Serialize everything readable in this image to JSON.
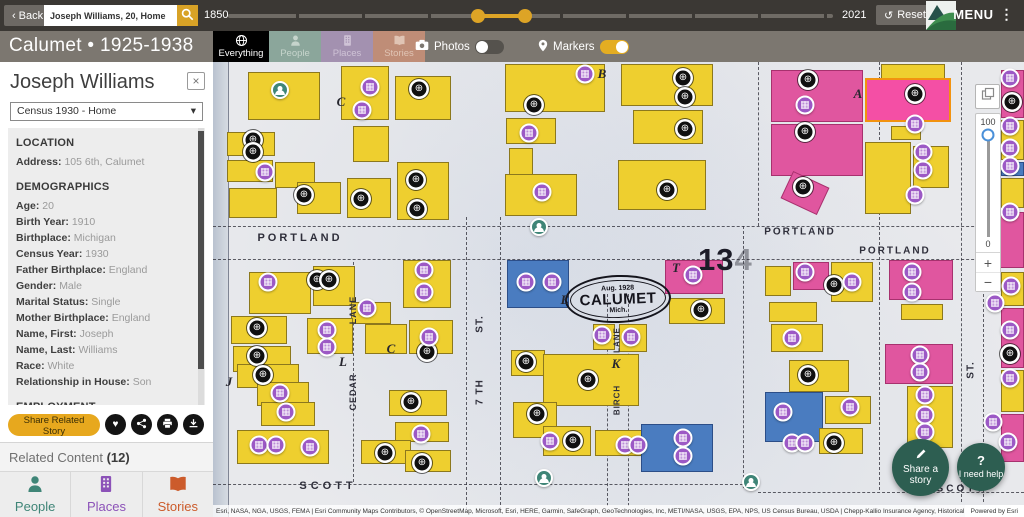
{
  "icons": {
    "back_chevron": "‹",
    "menu_kebab": "⋮",
    "reset": "↺",
    "select_caret": "▾",
    "close": "×",
    "heart": "♥",
    "globe_marker": "⊕",
    "building_marker": "▦",
    "question": "?",
    "plus": "+",
    "minus": "−"
  },
  "colors": {
    "accent_gold": "#dda426",
    "topbar_bg": "#3b3834",
    "subheader_bg": "#7c7770",
    "people_teal": "#3f8577",
    "places_purple": "#8c52b8",
    "stories_orange": "#cc5b2b",
    "marker_record": "#101010",
    "marker_place": "#9c59c5",
    "marker_person": "#3f8577",
    "building_yellow": "#eecf2f",
    "building_pink": "#e0569f",
    "building_blue": "#4a7cc0",
    "fab_teal": "#2d5e51"
  },
  "topbar": {
    "back_label": "Back",
    "search_value": "Joseph Williams, 20, Home",
    "year_start": "1850",
    "year_end": "2021",
    "reset_label": "Reset",
    "menu_label": "MENU"
  },
  "subheader": {
    "title": "Calumet • 1925-1938",
    "tabs": [
      {
        "label": "Everything",
        "active": true
      },
      {
        "label": "People",
        "active": false
      },
      {
        "label": "Places",
        "active": false
      },
      {
        "label": "Stories",
        "active": false
      }
    ],
    "toggles": [
      {
        "label": "Photos",
        "on": false
      },
      {
        "label": "Markers",
        "on": true
      }
    ]
  },
  "sidebar": {
    "person_name": "Joseph Williams",
    "record_select": "Census 1930 - Home",
    "sections": [
      {
        "header": "LOCATION",
        "fields": [
          {
            "label": "Address",
            "value": "105 6th, Calumet"
          }
        ]
      },
      {
        "header": "DEMOGRAPHICS",
        "fields": [
          {
            "label": "Age",
            "value": "20"
          },
          {
            "label": "Birth Year",
            "value": "1910"
          },
          {
            "label": "Birthplace",
            "value": "Michigan"
          },
          {
            "label": "Census Year",
            "value": "1930"
          },
          {
            "label": "Father Birthplace",
            "value": "England"
          },
          {
            "label": "Gender",
            "value": "Male"
          },
          {
            "label": "Marital Status",
            "value": "Single"
          },
          {
            "label": "Mother Birthplace",
            "value": "England"
          },
          {
            "label": "Name, First",
            "value": "Joseph"
          },
          {
            "label": "Name, Last",
            "value": "Williams"
          },
          {
            "label": "Race",
            "value": "White"
          },
          {
            "label": "Relationship in House",
            "value": "Son"
          }
        ]
      },
      {
        "header": "EMPLOYMENT",
        "fields": []
      }
    ],
    "share_button": "Share Related Story",
    "related_label": "Related Content",
    "related_count": "(12)",
    "footer_tabs": [
      {
        "label": "People"
      },
      {
        "label": "Places"
      },
      {
        "label": "Stories"
      }
    ]
  },
  "map": {
    "plate_number": "134",
    "stamp": {
      "top": "Aug. 1928",
      "main": "CALUMET",
      "bottom": "Mich."
    },
    "street_labels": [
      {
        "t": "PORTLAND",
        "x": 87,
        "y": 176,
        "s": 11,
        "ls": 3
      },
      {
        "t": "PORTLAND",
        "x": 587,
        "y": 170,
        "s": 10,
        "ls": 2
      },
      {
        "t": "PORTLAND",
        "x": 682,
        "y": 189,
        "s": 10,
        "ls": 2
      },
      {
        "t": "SCOTT",
        "x": 115,
        "y": 424,
        "s": 11,
        "ls": 4
      },
      {
        "t": "SCOTT",
        "x": 748,
        "y": 427,
        "s": 10,
        "ls": 3
      },
      {
        "t": "LANE",
        "x": 140,
        "y": 248,
        "s": 9,
        "ls": 1,
        "v": true
      },
      {
        "t": "CEDAR",
        "x": 140,
        "y": 330,
        "s": 9,
        "ls": 1,
        "v": true
      },
      {
        "t": "ST.",
        "x": 267,
        "y": 262,
        "s": 10,
        "ls": 1,
        "v": true
      },
      {
        "t": "7 TH",
        "x": 267,
        "y": 330,
        "s": 10,
        "ls": 1,
        "v": true
      },
      {
        "t": "LANE",
        "x": 404,
        "y": 278,
        "s": 8,
        "ls": 1,
        "v": true
      },
      {
        "t": "BIRCH",
        "x": 404,
        "y": 338,
        "s": 8,
        "ls": 1,
        "v": true
      },
      {
        "t": "ST.",
        "x": 758,
        "y": 308,
        "s": 10,
        "ls": 1,
        "v": true
      }
    ],
    "block_letters": [
      {
        "t": "B",
        "x": 389,
        "y": 12
      },
      {
        "t": "C",
        "x": 128,
        "y": 40
      },
      {
        "t": "A",
        "x": 645,
        "y": 32
      },
      {
        "t": "J",
        "x": 16,
        "y": 320
      },
      {
        "t": "L",
        "x": 130,
        "y": 300
      },
      {
        "t": "C",
        "x": 178,
        "y": 287
      },
      {
        "t": "K",
        "x": 403,
        "y": 302
      },
      {
        "t": "T",
        "x": 463,
        "y": 206
      },
      {
        "t": "E",
        "x": 352,
        "y": 238
      }
    ],
    "street_lines": [
      [
        "h",
        0,
        164,
        811
      ],
      [
        "h",
        0,
        197,
        811
      ],
      [
        "h",
        0,
        422,
        530
      ],
      [
        "h",
        545,
        430,
        266
      ],
      [
        "v",
        140,
        200,
        220
      ],
      [
        "v",
        253,
        155,
        293
      ],
      [
        "v",
        287,
        155,
        293
      ],
      [
        "v",
        394,
        232,
        212
      ],
      [
        "v",
        415,
        232,
        212
      ],
      [
        "v",
        530,
        164,
        262
      ],
      [
        "v",
        666,
        0,
        428
      ],
      [
        "v",
        748,
        0,
        440
      ],
      [
        "v",
        545,
        0,
        164
      ],
      [
        "v",
        770,
        197,
        243
      ]
    ],
    "building_colors": {
      "y": "yellow",
      "p": "pink",
      "b": "blue",
      "o": "pink-orange-outline"
    },
    "buildings": [
      [
        "y",
        35,
        10,
        72,
        48
      ],
      [
        "y",
        128,
        4,
        48,
        54
      ],
      [
        "y",
        182,
        14,
        56,
        44
      ],
      [
        "y",
        140,
        64,
        36,
        36
      ],
      [
        "y",
        14,
        70,
        48,
        24
      ],
      [
        "y",
        14,
        98,
        46,
        22
      ],
      [
        "y",
        62,
        100,
        40,
        26
      ],
      [
        "y",
        16,
        126,
        48,
        30
      ],
      [
        "y",
        84,
        120,
        44,
        32
      ],
      [
        "y",
        134,
        116,
        44,
        40
      ],
      [
        "y",
        184,
        100,
        52,
        58
      ],
      [
        "y",
        292,
        2,
        100,
        48
      ],
      [
        "y",
        293,
        56,
        50,
        26
      ],
      [
        "y",
        296,
        86,
        24,
        30
      ],
      [
        "y",
        292,
        112,
        72,
        42
      ],
      [
        "y",
        408,
        2,
        92,
        42
      ],
      [
        "y",
        420,
        48,
        70,
        34
      ],
      [
        "y",
        405,
        98,
        88,
        50
      ],
      [
        "p",
        558,
        8,
        92,
        52
      ],
      [
        "p",
        558,
        62,
        92,
        52
      ],
      [
        "p",
        572,
        116,
        40,
        30,
        25
      ],
      [
        "y",
        668,
        2,
        64,
        26
      ],
      [
        "o",
        652,
        16,
        86,
        44
      ],
      [
        "y",
        678,
        64,
        30,
        14
      ],
      [
        "y",
        652,
        80,
        46,
        72
      ],
      [
        "y",
        700,
        84,
        36,
        42
      ],
      [
        "p",
        788,
        8,
        23,
        48
      ],
      [
        "y",
        788,
        58,
        23,
        40
      ],
      [
        "b",
        788,
        100,
        23,
        14
      ],
      [
        "y",
        788,
        116,
        23,
        30
      ],
      [
        "p",
        770,
        150,
        41,
        56
      ],
      [
        "y",
        788,
        210,
        23,
        34
      ],
      [
        "p",
        788,
        246,
        23,
        60
      ],
      [
        "y",
        788,
        308,
        23,
        42
      ],
      [
        "p",
        788,
        352,
        23,
        48
      ],
      [
        "y",
        36,
        210,
        62,
        42
      ],
      [
        "y",
        100,
        204,
        42,
        40
      ],
      [
        "y",
        190,
        198,
        48,
        48
      ],
      [
        "y",
        138,
        240,
        40,
        22
      ],
      [
        "y",
        94,
        256,
        46,
        36
      ],
      [
        "y",
        18,
        254,
        56,
        28
      ],
      [
        "y",
        20,
        284,
        58,
        26
      ],
      [
        "y",
        24,
        302,
        62,
        24
      ],
      [
        "y",
        44,
        320,
        52,
        24
      ],
      [
        "y",
        48,
        340,
        54,
        24
      ],
      [
        "y",
        24,
        368,
        92,
        34
      ],
      [
        "y",
        152,
        262,
        42,
        30
      ],
      [
        "y",
        196,
        258,
        44,
        34
      ],
      [
        "y",
        176,
        328,
        58,
        26
      ],
      [
        "y",
        182,
        360,
        54,
        20
      ],
      [
        "y",
        148,
        378,
        50,
        24
      ],
      [
        "y",
        192,
        388,
        46,
        22
      ],
      [
        "b",
        294,
        198,
        62,
        48
      ],
      [
        "p",
        452,
        198,
        58,
        34
      ],
      [
        "y",
        456,
        236,
        56,
        26
      ],
      [
        "y",
        380,
        262,
        22,
        26
      ],
      [
        "y",
        406,
        262,
        28,
        28
      ],
      [
        "y",
        298,
        288,
        34,
        26
      ],
      [
        "y",
        330,
        292,
        96,
        52
      ],
      [
        "y",
        300,
        340,
        44,
        36
      ],
      [
        "y",
        330,
        364,
        48,
        30
      ],
      [
        "y",
        382,
        368,
        52,
        26
      ],
      [
        "b",
        428,
        362,
        72,
        48
      ],
      [
        "y",
        552,
        204,
        26,
        30
      ],
      [
        "p",
        580,
        200,
        36,
        28
      ],
      [
        "y",
        618,
        200,
        42,
        40
      ],
      [
        "y",
        556,
        240,
        48,
        20
      ],
      [
        "y",
        558,
        262,
        52,
        28
      ],
      [
        "y",
        576,
        298,
        60,
        32
      ],
      [
        "b",
        552,
        330,
        58,
        50
      ],
      [
        "y",
        612,
        334,
        46,
        28
      ],
      [
        "y",
        606,
        366,
        44,
        26
      ],
      [
        "p",
        676,
        198,
        64,
        40
      ],
      [
        "y",
        688,
        242,
        42,
        16
      ],
      [
        "p",
        672,
        282,
        68,
        40
      ],
      [
        "y",
        694,
        324,
        46,
        62
      ]
    ],
    "marker_types": {
      "r": "record",
      "p": "place",
      "s": "person"
    },
    "markers": [
      [
        "s",
        67,
        28
      ],
      [
        "s",
        326,
        165
      ],
      [
        "s",
        331,
        416
      ],
      [
        "s",
        538,
        420
      ],
      [
        "r",
        206,
        27
      ],
      [
        "r",
        321,
        43
      ],
      [
        "r",
        470,
        16
      ],
      [
        "r",
        472,
        35
      ],
      [
        "r",
        472,
        67
      ],
      [
        "r",
        454,
        128
      ],
      [
        "r",
        40,
        78
      ],
      [
        "r",
        40,
        90
      ],
      [
        "r",
        91,
        133
      ],
      [
        "r",
        148,
        137
      ],
      [
        "r",
        203,
        118
      ],
      [
        "r",
        204,
        147
      ],
      [
        "r",
        595,
        18
      ],
      [
        "r",
        592,
        70
      ],
      [
        "r",
        590,
        125
      ],
      [
        "r",
        702,
        32
      ],
      [
        "r",
        104,
        218
      ],
      [
        "r",
        116,
        218
      ],
      [
        "r",
        44,
        266
      ],
      [
        "r",
        44,
        294
      ],
      [
        "r",
        50,
        313
      ],
      [
        "r",
        214,
        290
      ],
      [
        "r",
        198,
        340
      ],
      [
        "r",
        172,
        391
      ],
      [
        "r",
        209,
        401
      ],
      [
        "r",
        313,
        300
      ],
      [
        "r",
        375,
        318
      ],
      [
        "r",
        324,
        352
      ],
      [
        "r",
        360,
        379
      ],
      [
        "r",
        488,
        248
      ],
      [
        "r",
        621,
        223
      ],
      [
        "r",
        595,
        313
      ],
      [
        "r",
        621,
        381
      ],
      [
        "r",
        799,
        40
      ],
      [
        "r",
        797,
        292
      ],
      [
        "p",
        157,
        25
      ],
      [
        "p",
        149,
        48
      ],
      [
        "p",
        52,
        110
      ],
      [
        "p",
        372,
        12
      ],
      [
        "p",
        316,
        71
      ],
      [
        "p",
        329,
        130
      ],
      [
        "p",
        592,
        43
      ],
      [
        "p",
        702,
        62
      ],
      [
        "p",
        710,
        90
      ],
      [
        "p",
        710,
        108
      ],
      [
        "p",
        702,
        133
      ],
      [
        "p",
        55,
        220
      ],
      [
        "p",
        154,
        246
      ],
      [
        "p",
        114,
        268
      ],
      [
        "p",
        114,
        285
      ],
      [
        "p",
        211,
        208
      ],
      [
        "p",
        211,
        230
      ],
      [
        "p",
        216,
        275
      ],
      [
        "p",
        67,
        331
      ],
      [
        "p",
        73,
        350
      ],
      [
        "p",
        46,
        383
      ],
      [
        "p",
        63,
        383
      ],
      [
        "p",
        97,
        385
      ],
      [
        "p",
        208,
        372
      ],
      [
        "p",
        313,
        220
      ],
      [
        "p",
        339,
        220
      ],
      [
        "p",
        480,
        213
      ],
      [
        "p",
        389,
        273
      ],
      [
        "p",
        418,
        275
      ],
      [
        "p",
        337,
        379
      ],
      [
        "p",
        412,
        383
      ],
      [
        "p",
        425,
        383
      ],
      [
        "p",
        470,
        376
      ],
      [
        "p",
        470,
        394
      ],
      [
        "p",
        592,
        210
      ],
      [
        "p",
        639,
        220
      ],
      [
        "p",
        579,
        276
      ],
      [
        "p",
        570,
        350
      ],
      [
        "p",
        579,
        381
      ],
      [
        "p",
        592,
        381
      ],
      [
        "p",
        637,
        345
      ],
      [
        "p",
        699,
        210
      ],
      [
        "p",
        699,
        230
      ],
      [
        "p",
        707,
        293
      ],
      [
        "p",
        707,
        310
      ],
      [
        "p",
        712,
        333
      ],
      [
        "p",
        712,
        353
      ],
      [
        "p",
        712,
        370
      ],
      [
        "p",
        797,
        16
      ],
      [
        "p",
        797,
        64
      ],
      [
        "p",
        797,
        86
      ],
      [
        "p",
        797,
        104
      ],
      [
        "p",
        797,
        150
      ],
      [
        "p",
        798,
        224
      ],
      [
        "p",
        782,
        241
      ],
      [
        "p",
        797,
        268
      ],
      [
        "p",
        797,
        316
      ],
      [
        "p",
        780,
        360
      ],
      [
        "p",
        795,
        380
      ]
    ],
    "controls": {
      "opacity_top": "100",
      "opacity_bottom": "0"
    },
    "fabs": [
      {
        "label": "Share a story"
      },
      {
        "label": "I need help"
      }
    ],
    "attribution": "Esri, NASA, NGA, USGS, FEMA | Esri Community Maps Contributors, © OpenStreetMap, Microsoft, Esri, HERE, Garmin, SafeGraph, GeoTechnologies, Inc, METI/NASA, USGS, EPA, NPS, US Census Bureau, USDA | Chepp-Kallio Insurance Agency, Historical Envi...",
    "powered_by": "Powered by Esri"
  }
}
